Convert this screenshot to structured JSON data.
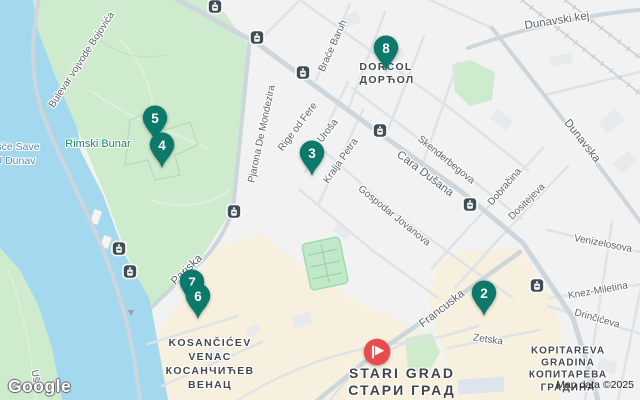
{
  "map": {
    "colors": {
      "water": "#a4d8ee",
      "park": "#cfebcd",
      "land": "#f1f2f1",
      "commercial_area": "#f8f0de",
      "quay": "#ebe7dc",
      "road_minor": "#dde3e6",
      "road_major": "#ccd6dc",
      "pin_teal": "#0c796b",
      "destination_red": "#ea4b4f",
      "transit_bg": "#3f4d55"
    },
    "attribution": {
      "logo": "Google",
      "map_data": "Map data ©2025"
    },
    "labels": {
      "streets": [
        {
          "text": "Bulevar vojvode Bojovića",
          "x": 82,
          "y": 60,
          "rot": -57,
          "cls": "street"
        },
        {
          "text": "Pjarona De Mondezira",
          "x": 262,
          "y": 134,
          "rot": -78,
          "cls": "street"
        },
        {
          "text": "Rige od Fere",
          "x": 298,
          "y": 127,
          "rot": -53,
          "cls": "street"
        },
        {
          "text": "Braće Baruh",
          "x": 333,
          "y": 46,
          "rot": -66,
          "cls": "street"
        },
        {
          "text": "Uroša",
          "x": 328,
          "y": 131,
          "rot": -52,
          "cls": "street"
        },
        {
          "text": "Kralja Petra",
          "x": 341,
          "y": 161,
          "rot": -55,
          "cls": "street"
        },
        {
          "text": "Gospodar Jovanova",
          "x": 394,
          "y": 216,
          "rot": 39,
          "cls": "street"
        },
        {
          "text": "Skenderbegova",
          "x": 446,
          "y": 160,
          "rot": 39,
          "cls": "street"
        },
        {
          "text": "Cara Dušana",
          "x": 425,
          "y": 174,
          "rot": 37,
          "cls": "street-lg"
        },
        {
          "text": "Dunavski kej",
          "x": 557,
          "y": 21,
          "rot": -9,
          "cls": "street-lg"
        },
        {
          "text": "Dunavska",
          "x": 582,
          "y": 141,
          "rot": 52,
          "cls": "street-lg"
        },
        {
          "text": "Dobračina",
          "x": 505,
          "y": 187,
          "rot": -49,
          "cls": "street"
        },
        {
          "text": "Dositejeva",
          "x": 527,
          "y": 202,
          "rot": -45,
          "cls": "street"
        },
        {
          "text": "Venizelosova",
          "x": 603,
          "y": 244,
          "rot": 11,
          "cls": "street"
        },
        {
          "text": "Knez-Miletina",
          "x": 598,
          "y": 291,
          "rot": -10,
          "cls": "street"
        },
        {
          "text": "Drinčićeva",
          "x": 597,
          "y": 319,
          "rot": 16,
          "cls": "street"
        },
        {
          "text": "Zetska",
          "x": 488,
          "y": 340,
          "rot": 8,
          "cls": "street"
        },
        {
          "text": "Francuska",
          "x": 442,
          "y": 309,
          "rot": -38,
          "cls": "street-lg"
        },
        {
          "text": "Pariska",
          "x": 187,
          "y": 270,
          "rot": -44,
          "cls": "street-lg"
        },
        {
          "text": "Uš",
          "x": 35,
          "y": 376,
          "rot": 80,
          "cls": "street"
        }
      ],
      "water": [
        {
          "text": "šće Save",
          "x": 18,
          "y": 147
        },
        {
          "text": "U Dunav",
          "x": 15,
          "y": 161
        }
      ],
      "parks": [
        {
          "text": "Rimski Bunar",
          "x": 98,
          "y": 144
        }
      ],
      "neighborhoods": [
        {
          "text": "DORĆOL",
          "x": 386,
          "y": 67,
          "cls": "hood"
        },
        {
          "text": "ДОРЋОЛ",
          "x": 387,
          "y": 80,
          "cls": "hood"
        },
        {
          "text": "KOSANČIĆEV",
          "x": 210,
          "y": 343,
          "cls": "hood"
        },
        {
          "text": "VENAC",
          "x": 210,
          "y": 357,
          "cls": "hood"
        },
        {
          "text": "КОСАНЧИЋЕВ",
          "x": 210,
          "y": 371,
          "cls": "hood"
        },
        {
          "text": "ВЕНАЦ",
          "x": 210,
          "y": 385,
          "cls": "hood"
        },
        {
          "text": "KOPITAREVA",
          "x": 568,
          "y": 351,
          "cls": "hood-sm"
        },
        {
          "text": "GRADINA",
          "x": 568,
          "y": 363,
          "cls": "hood-sm"
        },
        {
          "text": "КОПИТАРЕВА",
          "x": 568,
          "y": 375,
          "cls": "hood-sm"
        },
        {
          "text": "ГРАДИНА",
          "x": 568,
          "y": 388,
          "cls": "hood-sm"
        },
        {
          "text": "STARI GRAD",
          "x": 402,
          "y": 373,
          "cls": "hood-lg"
        },
        {
          "text": "СТАРИ ГРАД",
          "x": 402,
          "y": 390,
          "cls": "hood-lg"
        }
      ]
    },
    "markers": {
      "numbered": [
        {
          "label": "5",
          "x": 155,
          "y": 118
        },
        {
          "label": "4",
          "x": 162,
          "y": 145
        },
        {
          "label": "8",
          "x": 386,
          "y": 48
        },
        {
          "label": "3",
          "x": 312,
          "y": 153
        },
        {
          "label": "7",
          "x": 192,
          "y": 282
        },
        {
          "label": "6",
          "x": 198,
          "y": 296
        },
        {
          "label": "2",
          "x": 484,
          "y": 293
        }
      ],
      "destination": {
        "x": 377,
        "y": 352
      }
    },
    "transit_stops": [
      {
        "x": 215,
        "y": 9
      },
      {
        "x": 257,
        "y": 40
      },
      {
        "x": 303,
        "y": 75
      },
      {
        "x": 380,
        "y": 133
      },
      {
        "x": 470,
        "y": 207
      },
      {
        "x": 537,
        "y": 288
      },
      {
        "x": 234,
        "y": 214
      },
      {
        "x": 119,
        "y": 251
      },
      {
        "x": 130,
        "y": 274
      }
    ],
    "one_way_arrow": {
      "x": 131,
      "y": 313
    }
  }
}
